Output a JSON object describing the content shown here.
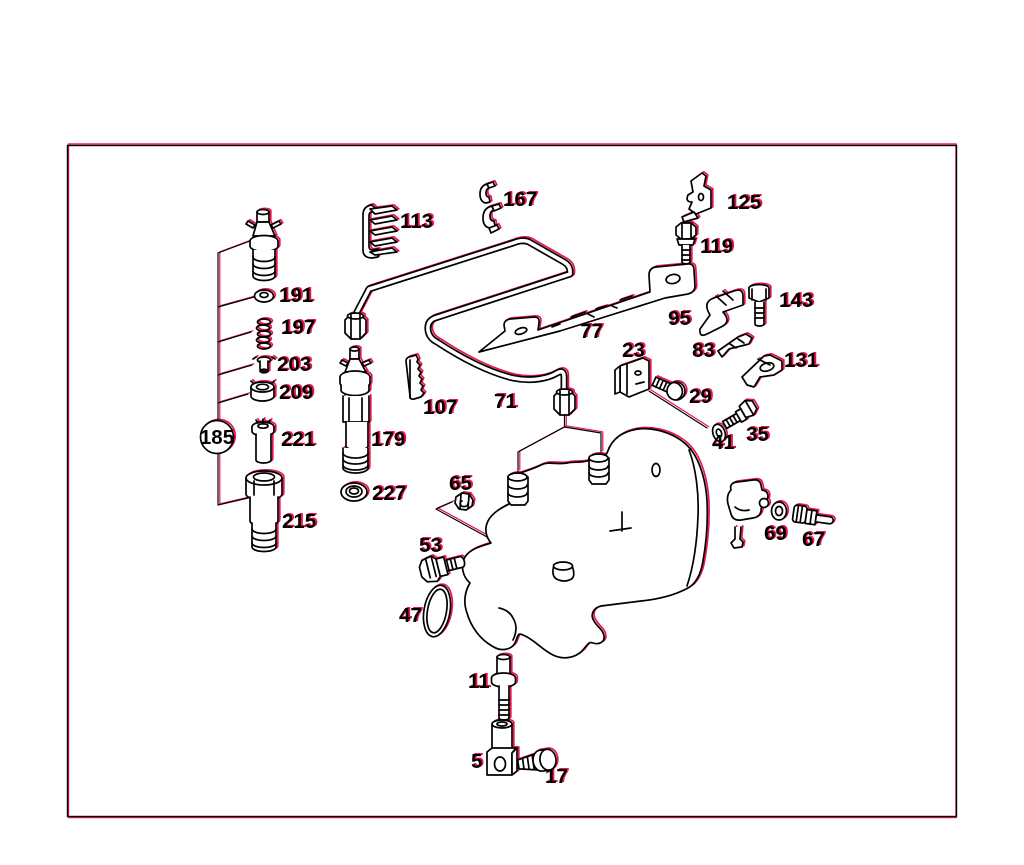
{
  "diagram": {
    "type": "exploded-parts-diagram",
    "colors": {
      "ink": "#000000",
      "accent_red": "#e8174b",
      "paper": "#ffffff"
    },
    "callouts": {
      "c5": "5",
      "c11": "11",
      "c17": "17",
      "c23": "23",
      "c29": "29",
      "c35": "35",
      "c41": "41",
      "c47": "47",
      "c53": "53",
      "c65": "65",
      "c67": "67",
      "c69": "69",
      "c71": "71",
      "c77": "77",
      "c83": "83",
      "c95": "95",
      "c107": "107",
      "c113": "113",
      "c119": "119",
      "c125": "125",
      "c131": "131",
      "c143": "143",
      "c167": "167",
      "c179": "179",
      "c185": "185",
      "c191": "191",
      "c197": "197",
      "c203": "203",
      "c209": "209",
      "c215": "215",
      "c221": "221",
      "c227": "227"
    }
  }
}
